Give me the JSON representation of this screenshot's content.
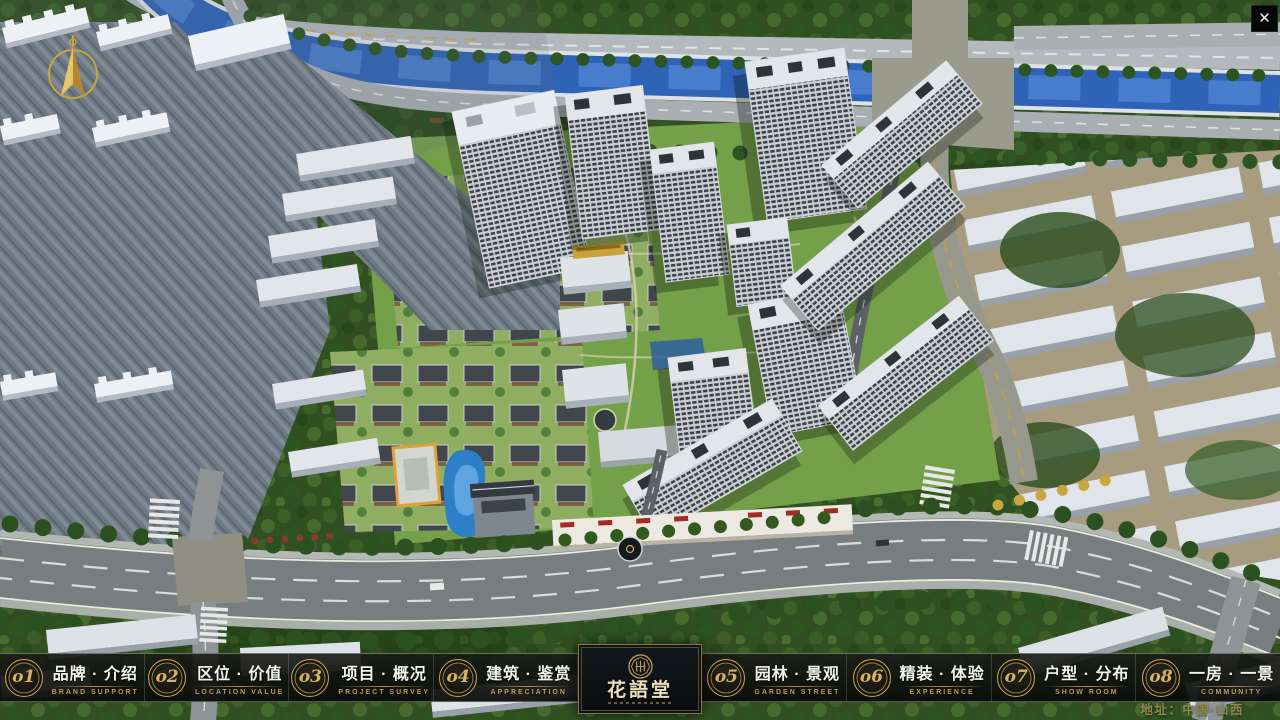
{
  "window": {
    "close_icon": "✕"
  },
  "logo": {
    "title": "花語堂"
  },
  "nav": {
    "items": [
      {
        "num": "o1",
        "label": "品牌 · 介绍",
        "sub": "BRAND SUPPORT"
      },
      {
        "num": "o2",
        "label": "区位 · 价值",
        "sub": "LOCATION VALUE"
      },
      {
        "num": "o3",
        "label": "项目 · 概况",
        "sub": "PROJECT SURVEY"
      },
      {
        "num": "o4",
        "label": "建筑 · 鉴赏",
        "sub": "APPRECIATION"
      },
      {
        "num": "o5",
        "label": "园林 · 景观",
        "sub": "GARDEN STREET"
      },
      {
        "num": "o6",
        "label": "精装 · 体验",
        "sub": "EXPERIENCE"
      },
      {
        "num": "o7",
        "label": "户型 · 分布",
        "sub": "SHOW ROOM"
      },
      {
        "num": "o8",
        "label": "一房 · 一景",
        "sub": "COMMUNITY"
      }
    ]
  },
  "footer": {
    "address": "地址：中国·山西"
  },
  "colors": {
    "gold": "#c9a661",
    "gold_dark": "#8a7347",
    "bar_background": "rgba(10,12,10,0.9)",
    "address_text": "#8f894a",
    "river_blue": "#2e63b8",
    "close_background": "#060606"
  }
}
